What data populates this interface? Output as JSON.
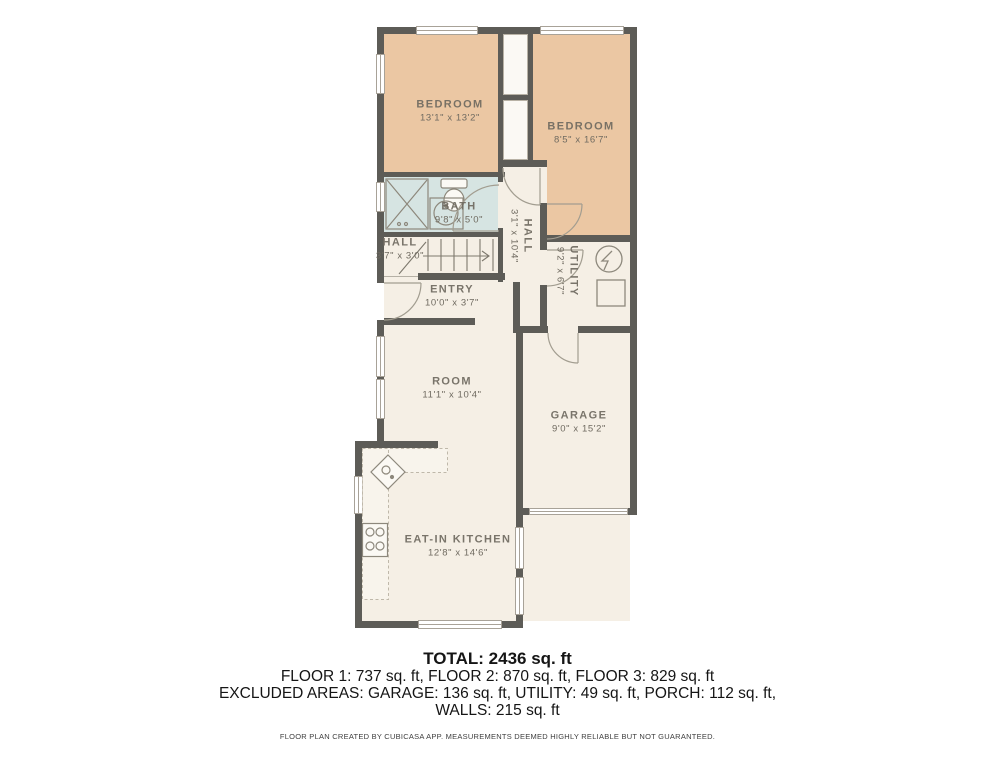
{
  "colors": {
    "wall": "#5d5c57",
    "bedroom_fill": "#ebc7a3",
    "bath_fill": "#d6e4e2",
    "floor_fill": "#f5efe5",
    "label_text": "#6f6a60",
    "summary_text": "#151515"
  },
  "plan": {
    "rooms": {
      "bedroom1": {
        "name": "BEDROOM",
        "dims": "13'1\" x 13'2\""
      },
      "bedroom2": {
        "name": "BEDROOM",
        "dims": "8'5\" x 16'7\""
      },
      "bath": {
        "name": "BATH",
        "dims": "9'8\" x 5'0\""
      },
      "hall_upper": {
        "name": "HALL",
        "dims": "3'7\" x 3'0\""
      },
      "hall_lower": {
        "name": "HALL",
        "dims": "3'1\" x 10'4\""
      },
      "entry": {
        "name": "ENTRY",
        "dims": "10'0\" x 3'7\""
      },
      "utility": {
        "name": "UTILITY",
        "dims": "9'2\" x 6'7\""
      },
      "room": {
        "name": "ROOM",
        "dims": "11'1\" x 10'4\""
      },
      "garage": {
        "name": "GARAGE",
        "dims": "9'0\" x 15'2\""
      },
      "kitchen": {
        "name": "EAT-IN KITCHEN",
        "dims": "12'8\" x 14'6\""
      }
    },
    "icons": [
      "shower-icon",
      "toilet-icon",
      "bath-sink-icon",
      "stairs-icon",
      "kitchen-sink-icon",
      "stove-icon",
      "electrical-panel-icon",
      "water-heater-icon",
      "door-arc-icon",
      "window-icon"
    ]
  },
  "summary": {
    "total": "TOTAL: 2436 sq. ft",
    "floors": "FLOOR 1: 737 sq. ft, FLOOR 2: 870 sq. ft, FLOOR 3: 829 sq. ft",
    "excluded": "EXCLUDED AREAS: GARAGE: 136 sq. ft, UTILITY: 49 sq. ft, PORCH: 112 sq. ft,",
    "walls": "WALLS: 215 sq. ft",
    "disclaimer": "FLOOR PLAN CREATED BY CUBICASA APP. MEASUREMENTS DEEMED HIGHLY RELIABLE BUT NOT GUARANTEED."
  }
}
